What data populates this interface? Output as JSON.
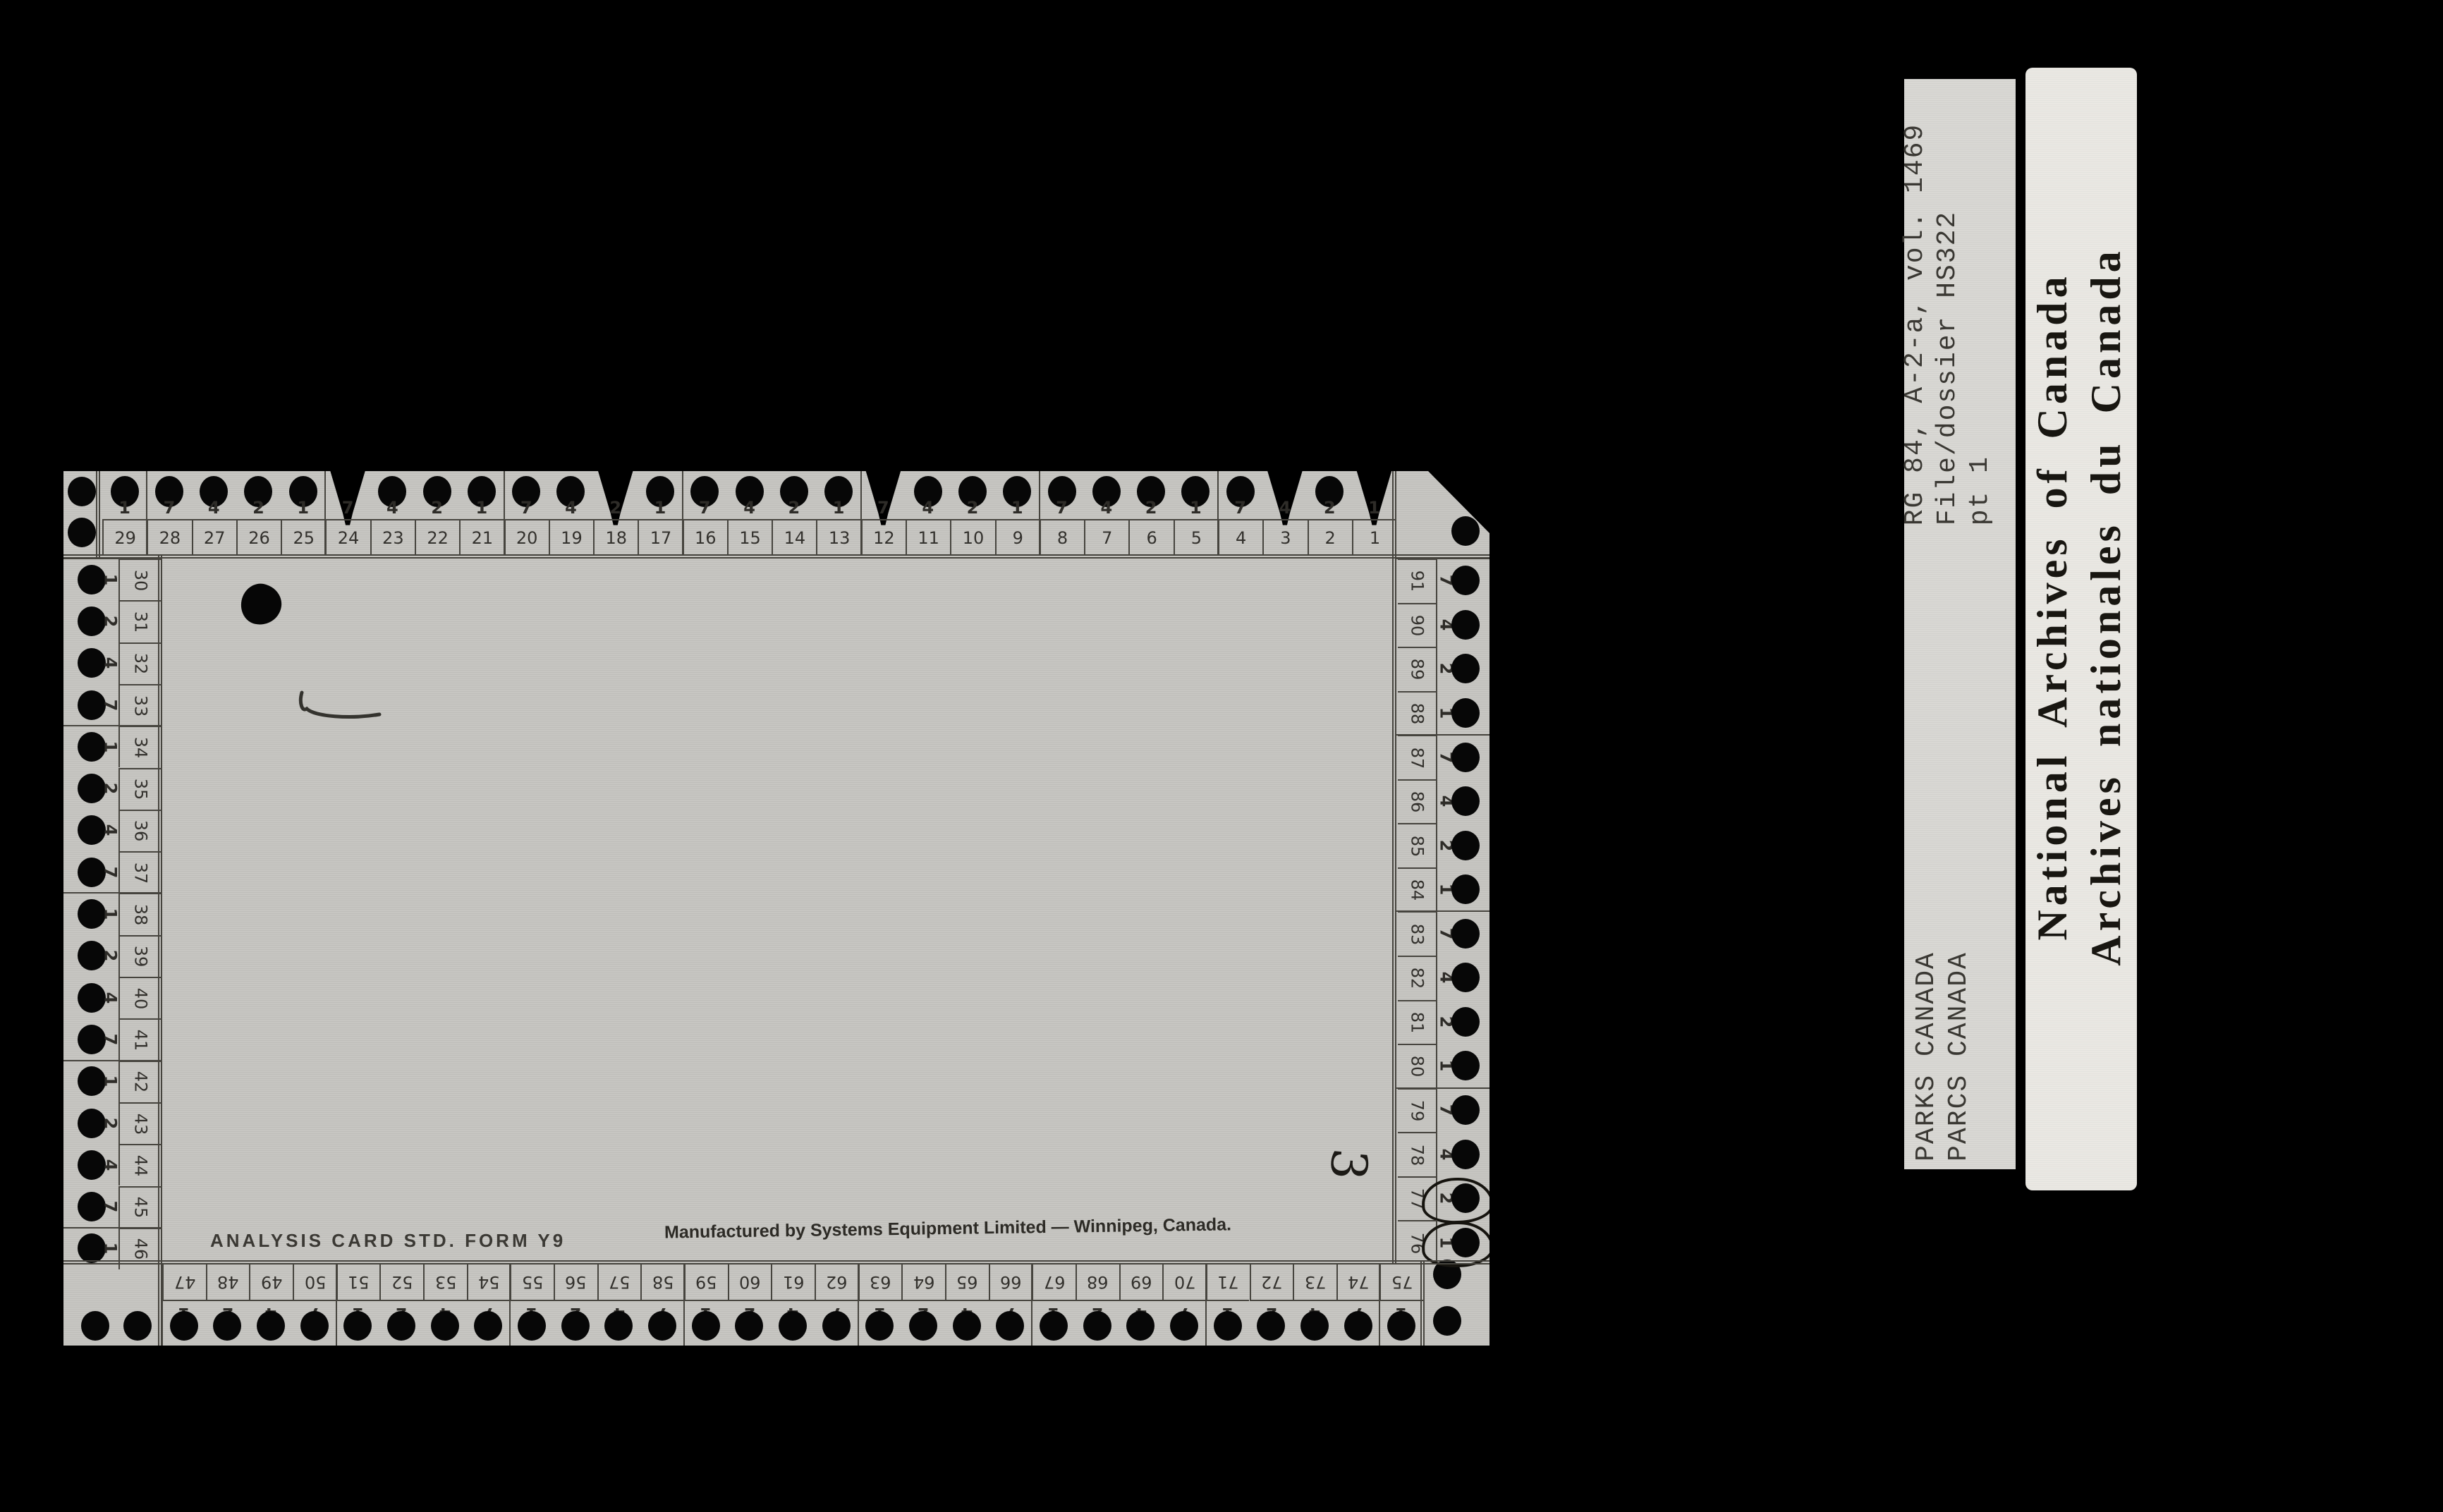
{
  "colors": {
    "background": "#000000",
    "card": "#c6c5c1",
    "ink": "#46443e",
    "hole": "#070707",
    "strip_label": "#d9d8d4",
    "big_label": "#eae8e3"
  },
  "card": {
    "analysis_text": "ANALYSIS CARD STD. FORM Y9",
    "manufacturer_text": "Manufactured by Systems Equipment Limited — Winnipeg, Canada.",
    "handwritten_number": "3",
    "top_edge": {
      "columns": [
        {
          "n": 29,
          "d": 1
        },
        {
          "n": 28,
          "d": 7
        },
        {
          "n": 27,
          "d": 4
        },
        {
          "n": 26,
          "d": 2
        },
        {
          "n": 25,
          "d": 1
        },
        {
          "n": 24,
          "d": 7,
          "notch": true
        },
        {
          "n": 23,
          "d": 4
        },
        {
          "n": 22,
          "d": 2
        },
        {
          "n": 21,
          "d": 1
        },
        {
          "n": 20,
          "d": 7
        },
        {
          "n": 19,
          "d": 4
        },
        {
          "n": 18,
          "d": 2,
          "notch": true
        },
        {
          "n": 17,
          "d": 1
        },
        {
          "n": 16,
          "d": 7
        },
        {
          "n": 15,
          "d": 4
        },
        {
          "n": 14,
          "d": 2
        },
        {
          "n": 13,
          "d": 1
        },
        {
          "n": 12,
          "d": 7,
          "notch": true
        },
        {
          "n": 11,
          "d": 4
        },
        {
          "n": 10,
          "d": 2
        },
        {
          "n": 9,
          "d": 1
        },
        {
          "n": 8,
          "d": 7
        },
        {
          "n": 7,
          "d": 4
        },
        {
          "n": 6,
          "d": 2
        },
        {
          "n": 5,
          "d": 1
        },
        {
          "n": 4,
          "d": 7
        },
        {
          "n": 3,
          "d": 4,
          "notch": true
        },
        {
          "n": 2,
          "d": 2
        },
        {
          "n": 1,
          "d": 1,
          "notch": true
        }
      ]
    },
    "left_edge": {
      "rows": [
        {
          "n": 30,
          "d": 1
        },
        {
          "n": 31,
          "d": 2
        },
        {
          "n": 32,
          "d": 4
        },
        {
          "n": 33,
          "d": 7
        },
        {
          "n": 34,
          "d": 1
        },
        {
          "n": 35,
          "d": 2
        },
        {
          "n": 36,
          "d": 4
        },
        {
          "n": 37,
          "d": 7
        },
        {
          "n": 38,
          "d": 1
        },
        {
          "n": 39,
          "d": 2
        },
        {
          "n": 40,
          "d": 4
        },
        {
          "n": 41,
          "d": 7
        },
        {
          "n": 42,
          "d": 1
        },
        {
          "n": 43,
          "d": 2
        },
        {
          "n": 44,
          "d": 4
        },
        {
          "n": 45,
          "d": 7
        },
        {
          "n": 46,
          "d": 1
        }
      ]
    },
    "right_edge": {
      "rows": [
        {
          "n": 91,
          "d": 7
        },
        {
          "n": 90,
          "d": 4
        },
        {
          "n": 89,
          "d": 2
        },
        {
          "n": 88,
          "d": 1
        },
        {
          "n": 87,
          "d": 7
        },
        {
          "n": 86,
          "d": 4
        },
        {
          "n": 85,
          "d": 2
        },
        {
          "n": 84,
          "d": 1
        },
        {
          "n": 83,
          "d": 7
        },
        {
          "n": 82,
          "d": 4
        },
        {
          "n": 81,
          "d": 2
        },
        {
          "n": 80,
          "d": 1
        },
        {
          "n": 79,
          "d": 7
        },
        {
          "n": 78,
          "d": 4
        },
        {
          "n": 77,
          "d": 2,
          "circled": true
        },
        {
          "n": 76,
          "d": 1,
          "circled": true
        }
      ]
    },
    "bottom_edge": {
      "columns": [
        {
          "n": 47,
          "d": 1
        },
        {
          "n": 48,
          "d": 2
        },
        {
          "n": 49,
          "d": 4
        },
        {
          "n": 50,
          "d": 7
        },
        {
          "n": 51,
          "d": 1
        },
        {
          "n": 52,
          "d": 2
        },
        {
          "n": 53,
          "d": 4
        },
        {
          "n": 54,
          "d": 7
        },
        {
          "n": 55,
          "d": 1
        },
        {
          "n": 56,
          "d": 2
        },
        {
          "n": 57,
          "d": 4
        },
        {
          "n": 58,
          "d": 7
        },
        {
          "n": 59,
          "d": 1
        },
        {
          "n": 60,
          "d": 2
        },
        {
          "n": 61,
          "d": 4
        },
        {
          "n": 62,
          "d": 7
        },
        {
          "n": 63,
          "d": 1
        },
        {
          "n": 64,
          "d": 2
        },
        {
          "n": 65,
          "d": 4
        },
        {
          "n": 66,
          "d": 7
        },
        {
          "n": 67,
          "d": 1
        },
        {
          "n": 68,
          "d": 2
        },
        {
          "n": 69,
          "d": 4
        },
        {
          "n": 70,
          "d": 7
        },
        {
          "n": 71,
          "d": 1
        },
        {
          "n": 72,
          "d": 2
        },
        {
          "n": 73,
          "d": 4
        },
        {
          "n": 74,
          "d": 7
        },
        {
          "n": 75,
          "d": 1
        }
      ]
    }
  },
  "labels": {
    "archive_reference": {
      "line1": "RG 84, A-2-a, vol. 1469",
      "line2": "File/dossier HS322",
      "line3": "pt 1"
    },
    "parks": {
      "line1": "PARKS CANADA",
      "line2": "PARCS CANADA"
    },
    "national_archives": {
      "line1": "National Archives of Canada",
      "line2": "Archives nationales du Canada"
    }
  }
}
